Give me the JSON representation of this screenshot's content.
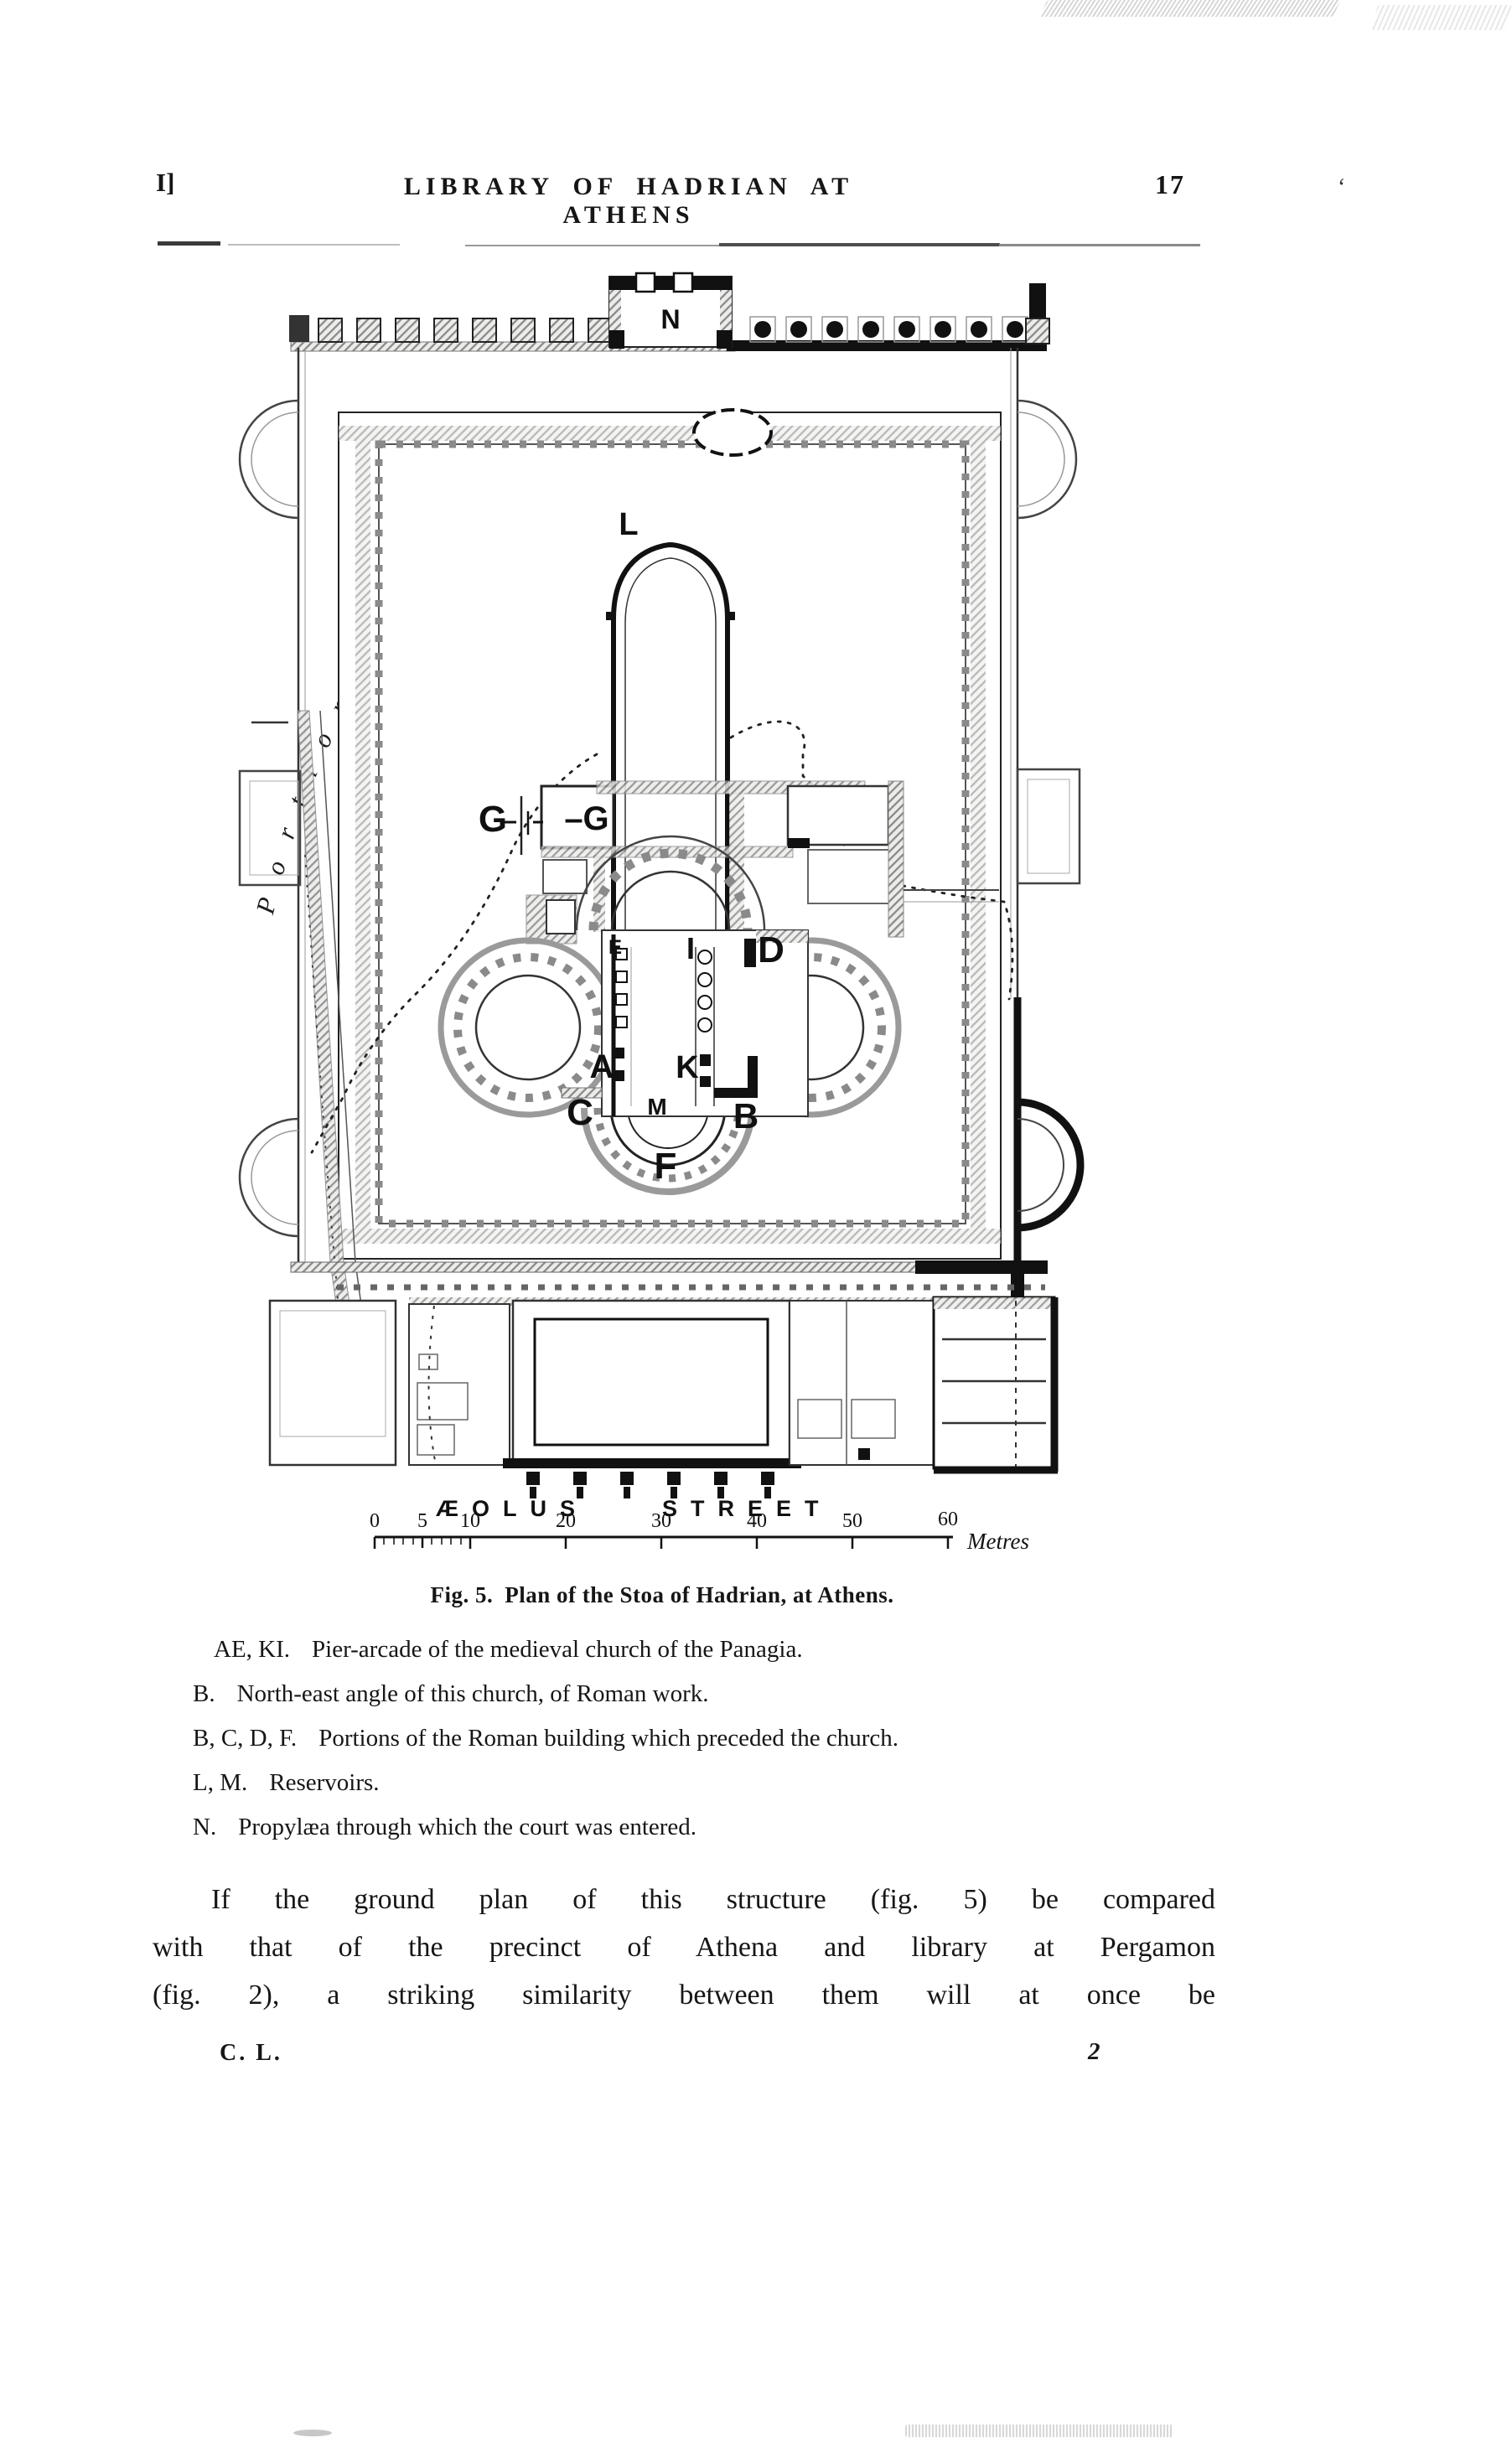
{
  "colors": {
    "ink": "#161616",
    "paper": "#ffffff",
    "wall_gray": "#8a8a8a"
  },
  "header": {
    "signature_mark": "I]",
    "title": "LIBRARY OF HADRIAN AT ATHENS",
    "page_number": "17",
    "stray_mark": "‘"
  },
  "figure": {
    "caption_fig": "Fig. 5.",
    "caption_text": "Plan of the Stoa of Hadrian, at Athens.",
    "curved_label": "Portion Unexcavated",
    "street_label_word1": "ÆOLUS",
    "street_label_word2": "STREET",
    "scale": {
      "ticks": [
        "0",
        "5",
        "10",
        "20",
        "30",
        "40",
        "50",
        "60"
      ],
      "unit": "Metres"
    },
    "plan_labels": {
      "propylaea": "N",
      "reservoir": "L",
      "g_outer": "G",
      "g_inner": "–G",
      "pier_e": "E",
      "pier_i": "I",
      "wall_d": "D",
      "pier_a": "A",
      "pier_k": "K",
      "angle_b": "B",
      "corner_c": "C",
      "reservoir_m": "M",
      "apse_f": "F"
    }
  },
  "legend": {
    "items": [
      {
        "key": "AE, KI.",
        "text": "Pier-arcade of the medieval church of the Panagia."
      },
      {
        "key": "B.",
        "text": "North-east angle of this church, of Roman work."
      },
      {
        "key": "B, C, D, F.",
        "text": "Portions of the Roman building which preceded the church."
      },
      {
        "key": "L, M.",
        "text": "Reservoirs."
      },
      {
        "key": "N.",
        "text": "Propylæa through which the court was entered."
      }
    ]
  },
  "body": {
    "lines": [
      "If the ground plan of this structure (fig. 5) be compared",
      "with that of the precinct of Athena and library at Pergamon",
      "(fig. 2), a striking similarity between them will at once be"
    ]
  },
  "footer": {
    "left": "C. L.",
    "right": "2"
  }
}
